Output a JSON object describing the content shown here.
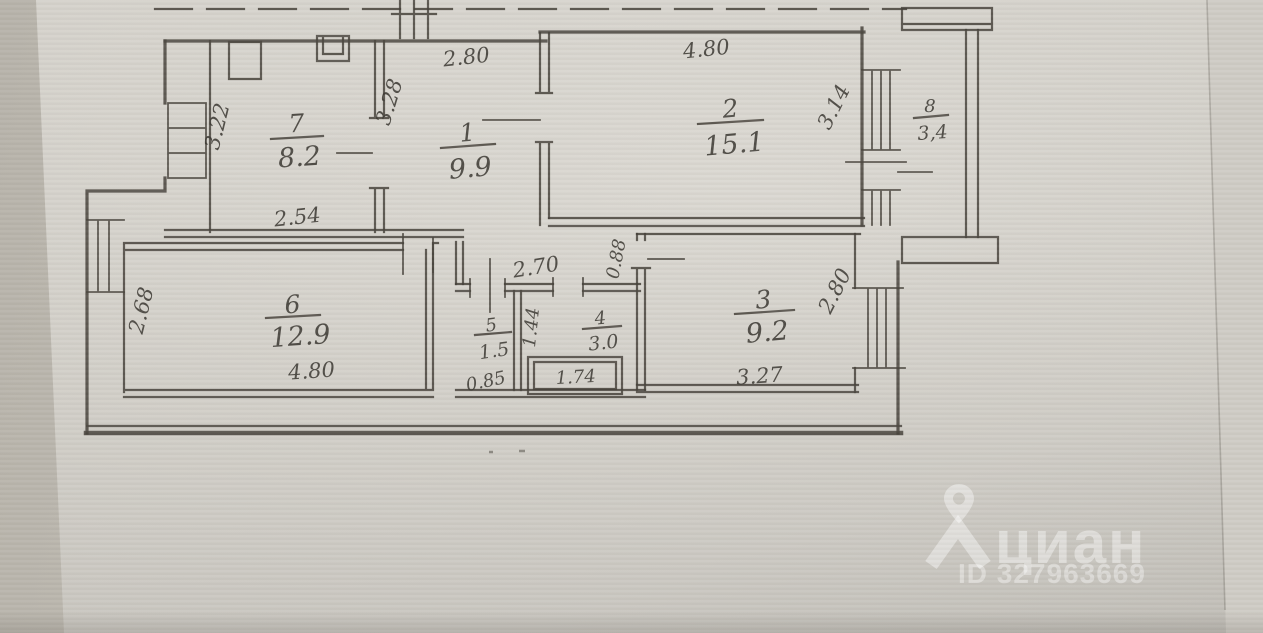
{
  "document": {
    "type": "apartment-floor-plan-scan"
  },
  "rooms": {
    "r7": {
      "number": "7",
      "area": "8.2"
    },
    "r1": {
      "number": "1",
      "area": "9.9"
    },
    "r2": {
      "number": "2",
      "area": "15.1"
    },
    "r8": {
      "number": "8",
      "area": "3,4"
    },
    "r6": {
      "number": "6",
      "area": "12.9"
    },
    "r5": {
      "number": "5",
      "area": "1.5"
    },
    "r4": {
      "number": "4",
      "area": "3.0"
    },
    "r3": {
      "number": "3",
      "area": "9.2"
    }
  },
  "dims": {
    "room7_side": "3.22",
    "room7_bottom": "2.54",
    "room1_top": "2.80",
    "room1_side": "3.28",
    "room2_top": "4.80",
    "room2_side": "3.14",
    "room6_side": "2.68",
    "room6_bottom": "4.80",
    "corridor": "2.70",
    "room5_bottom": "0.85",
    "room4_side": "1.44",
    "bath": "1.74",
    "room3_bottom": "3.27",
    "room3_side": "2.80",
    "wall": "0.88"
  },
  "watermark": {
    "brand": "циан",
    "id": "ID 327963669"
  }
}
